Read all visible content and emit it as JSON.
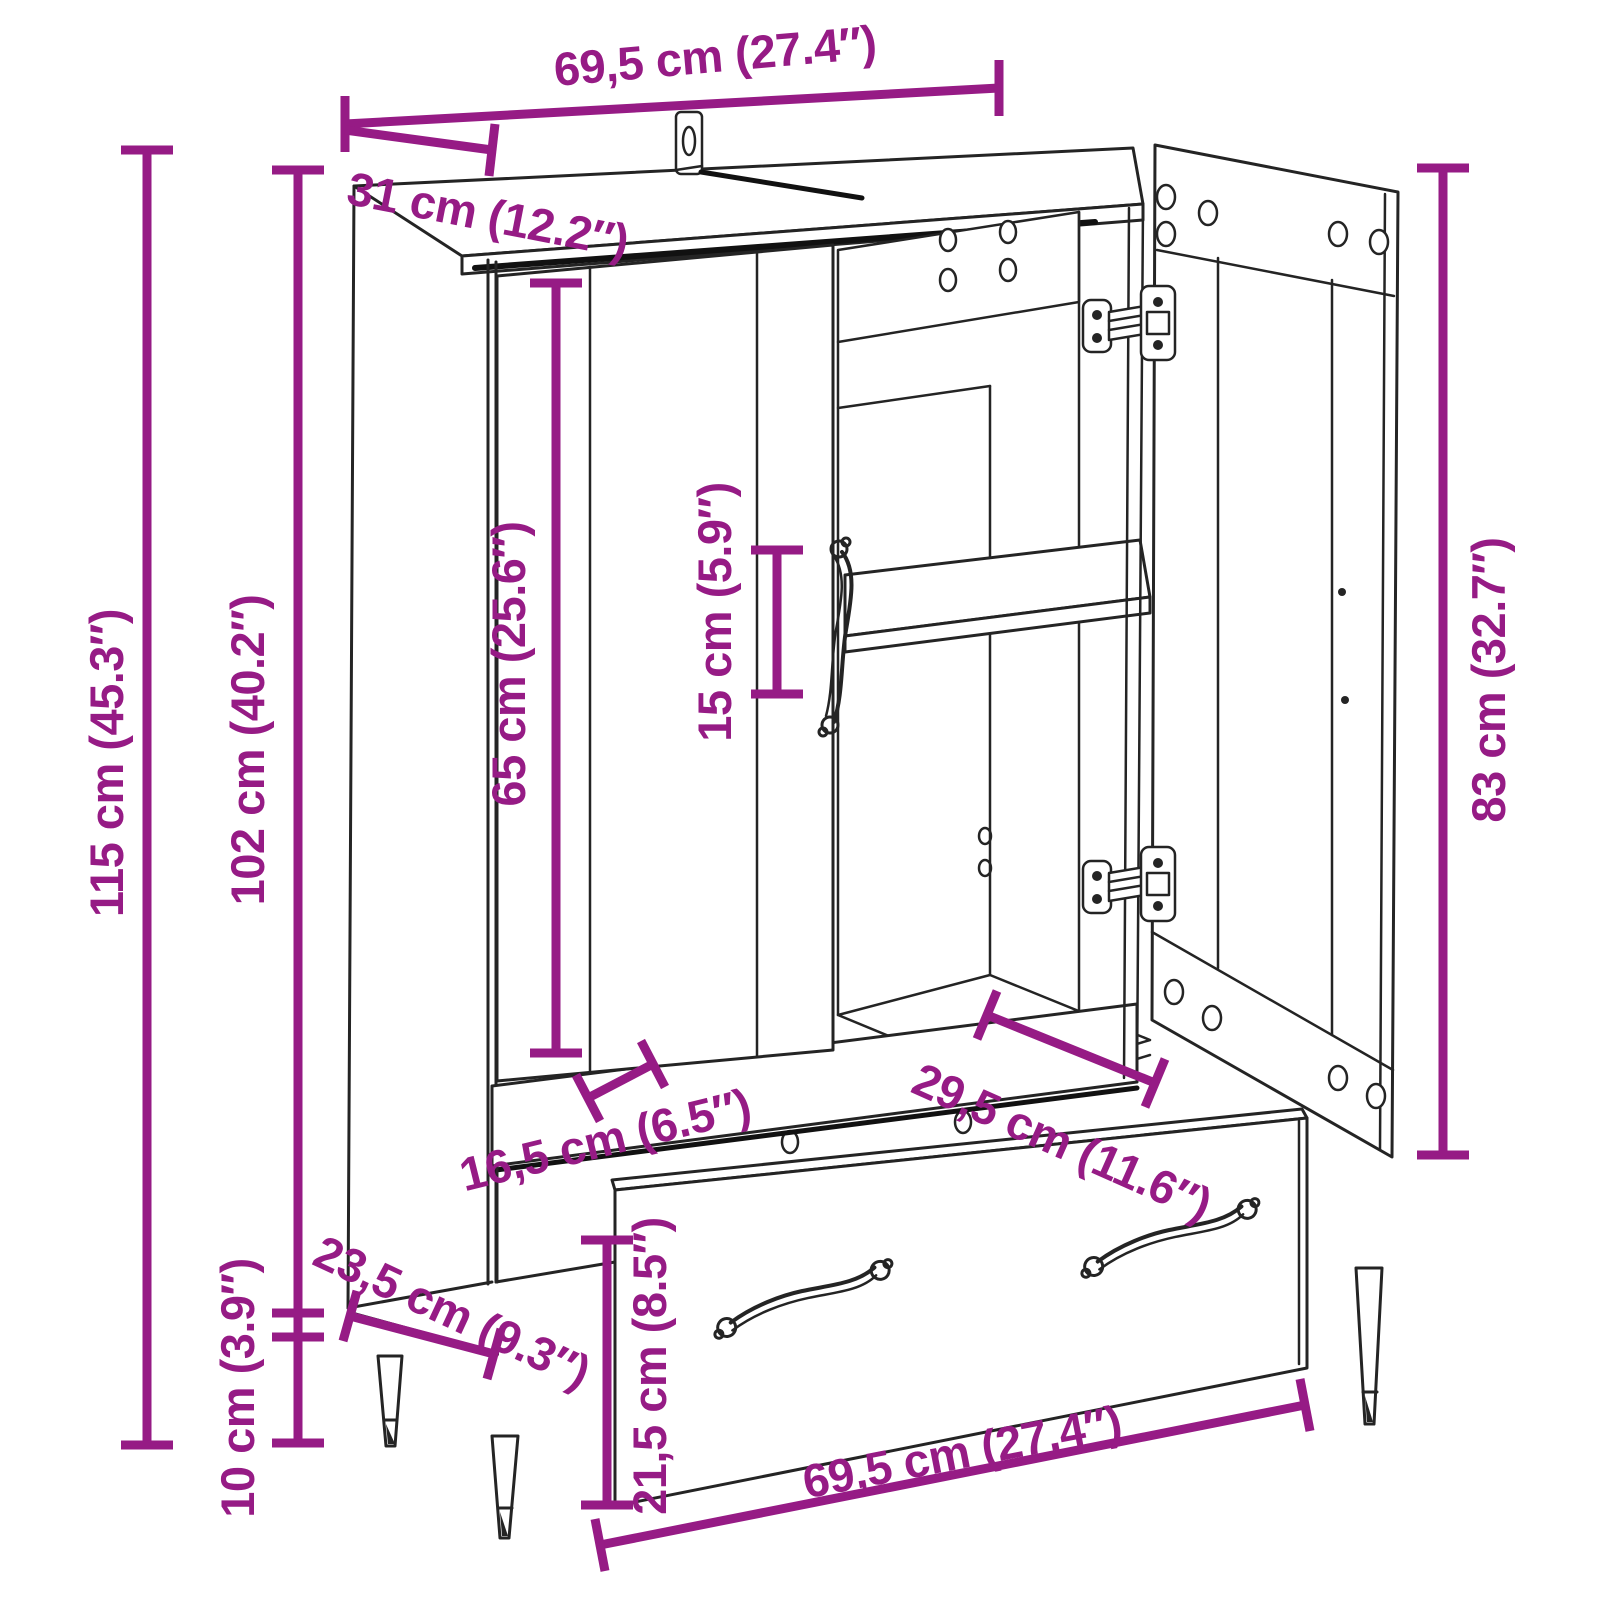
{
  "diagram": {
    "accent_color": "#961B85",
    "line_color": "#242424",
    "background_color": "#ffffff",
    "dimensions": {
      "width_top": {
        "label": "69,5 cm (27.4″)",
        "cm": 69.5,
        "in": 27.4
      },
      "depth_top": {
        "label": "31 cm (12.2″)",
        "cm": 31,
        "in": 12.2
      },
      "height_overall": {
        "label": "115 cm (45.3″)",
        "cm": 115,
        "in": 45.3
      },
      "height_carcass": {
        "label": "102 cm (40.2″)",
        "cm": 102,
        "in": 40.2
      },
      "door_height": {
        "label": "65 cm (25.6″)",
        "cm": 65,
        "in": 25.6
      },
      "handle_length": {
        "label": "15 cm (5.9″)",
        "cm": 15,
        "in": 5.9
      },
      "open_door_height": {
        "label": "83 cm (32.7″)",
        "cm": 83,
        "in": 32.7
      },
      "stile_width": {
        "label": "16,5 cm (6.5″)",
        "cm": 16.5,
        "in": 6.5
      },
      "interior_depth": {
        "label": "29,5 cm (11.6″)",
        "cm": 29.5,
        "in": 11.6
      },
      "base_depth": {
        "label": "23,5 cm (9.3″)",
        "cm": 23.5,
        "in": 9.3
      },
      "leg_height": {
        "label": "10 cm (3.9″)",
        "cm": 10,
        "in": 3.9
      },
      "drawer_height": {
        "label": "21,5 cm (8.5″)",
        "cm": 21.5,
        "in": 8.5
      },
      "width_bottom": {
        "label": "69,5 cm (27.4″)",
        "cm": 69.5,
        "in": 27.4
      }
    }
  }
}
